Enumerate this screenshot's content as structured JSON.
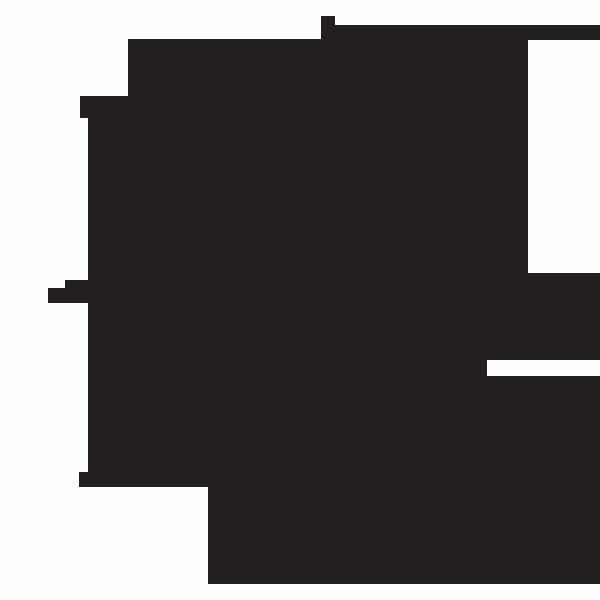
{
  "canvas": {
    "width": 600,
    "height": 600,
    "background": "#FEFEFE"
  },
  "silhouette": {
    "name": "abstract-blocky-silhouette",
    "fill": "#231F20",
    "points": [
      [
        128,
        39
      ],
      [
        321,
        39
      ],
      [
        321,
        16
      ],
      [
        335,
        16
      ],
      [
        335,
        25
      ],
      [
        600,
        25
      ],
      [
        600,
        40
      ],
      [
        528,
        40
      ],
      [
        528,
        273
      ],
      [
        600,
        273
      ],
      [
        600,
        360
      ],
      [
        487,
        360
      ],
      [
        487,
        376
      ],
      [
        600,
        376
      ],
      [
        600,
        584
      ],
      [
        208,
        584
      ],
      [
        208,
        487
      ],
      [
        79,
        487
      ],
      [
        79,
        472
      ],
      [
        88,
        472
      ],
      [
        88,
        303
      ],
      [
        48,
        303
      ],
      [
        48,
        288
      ],
      [
        65,
        288
      ],
      [
        65,
        280
      ],
      [
        88,
        280
      ],
      [
        88,
        118
      ],
      [
        80,
        118
      ],
      [
        80,
        96
      ],
      [
        128,
        96
      ]
    ]
  }
}
